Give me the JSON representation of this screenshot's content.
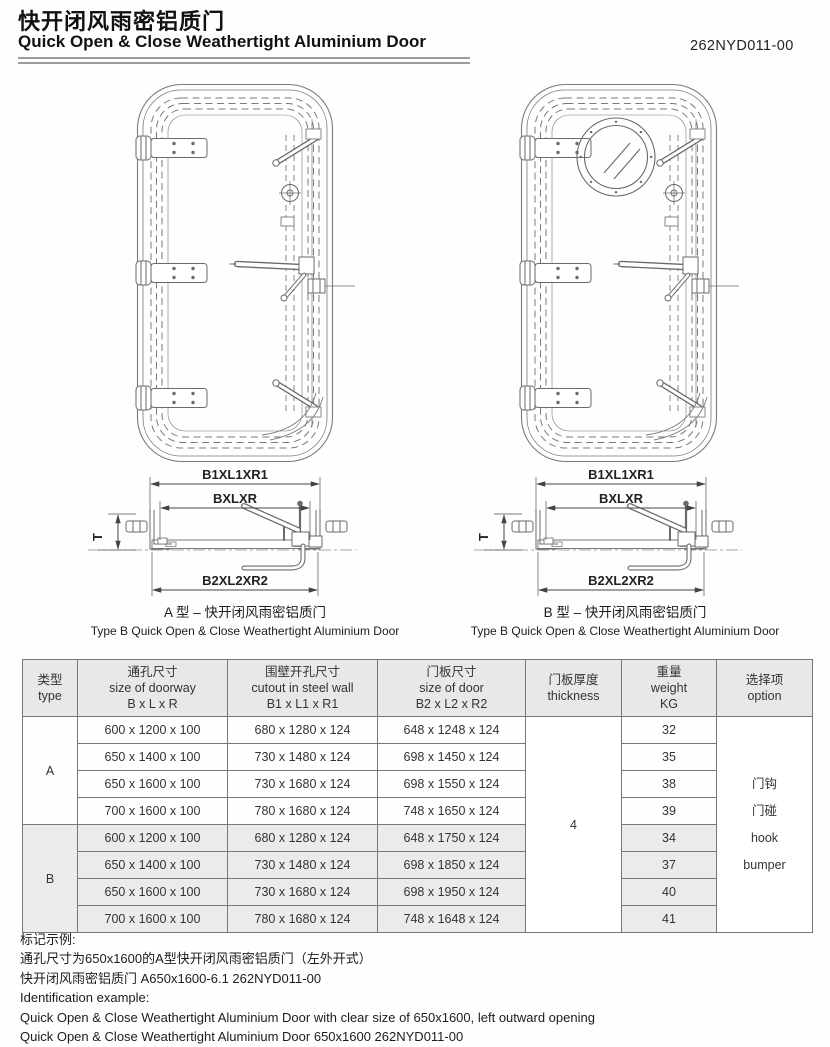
{
  "header": {
    "title_zh": "快开闭风雨密铝质门",
    "title_en": "Quick Open & Close Weathertight Aluminium Door",
    "doc_number": "262NYD011-00"
  },
  "diagrams": {
    "type_a": {
      "caption_zh": "A 型 – 快开闭风雨密铝质门",
      "caption_en": "Type B Quick Open & Close Weathertight Aluminium Door"
    },
    "type_b": {
      "caption_zh": "B 型 – 快开闭风雨密铝质门",
      "caption_en": "Type B Quick Open & Close Weathertight Aluminium Door"
    },
    "section_labels": {
      "top": "B1XL1XR1",
      "middle": "BXLXR",
      "bottom": "B2XL2XR2",
      "thickness": "T"
    }
  },
  "table": {
    "headers": {
      "type_zh": "类型",
      "type_en": "type",
      "doorway_zh": "通孔尺寸",
      "doorway_en": "size of doorway",
      "doorway_dims": "B x L x R",
      "cutout_zh": "围壁开孔尺寸",
      "cutout_en": "cutout in steel wall",
      "cutout_dims": "B1 x L1 x R1",
      "door_zh": "门板尺寸",
      "door_en": "size of door",
      "door_dims": "B2 x L2 x R2",
      "thickness_zh": "门板厚度",
      "thickness_en": "thickness",
      "weight_zh": "重量",
      "weight_en": "weight",
      "weight_unit": "KG",
      "option_zh": "选择项",
      "option_en": "option"
    },
    "thickness_value": "4",
    "option_lines": [
      "门钩",
      "门碰",
      "hook",
      "bumper"
    ],
    "groups": [
      {
        "type": "A",
        "rows": [
          {
            "doorway": "600 x 1200 x 100",
            "cutout": "680 x 1280 x 124",
            "door": "648 x 1248 x 124",
            "weight": "32"
          },
          {
            "doorway": "650 x 1400 x 100",
            "cutout": "730 x 1480 x 124",
            "door": "698 x 1450 x 124",
            "weight": "35"
          },
          {
            "doorway": "650 x 1600 x 100",
            "cutout": "730 x 1680 x 124",
            "door": "698 x 1550 x 124",
            "weight": "38"
          },
          {
            "doorway": "700 x 1600 x 100",
            "cutout": "780 x 1680 x 124",
            "door": "748 x 1650 x 124",
            "weight": "39"
          }
        ]
      },
      {
        "type": "B",
        "rows": [
          {
            "doorway": "600 x 1200 x 100",
            "cutout": "680 x 1280 x 124",
            "door": "648 x 1750 x 124",
            "weight": "34"
          },
          {
            "doorway": "650 x 1400 x 100",
            "cutout": "730 x 1480 x 124",
            "door": "698 x 1850 x 124",
            "weight": "37"
          },
          {
            "doorway": "650 x 1600 x 100",
            "cutout": "730 x 1680 x 124",
            "door": "698 x 1950 x 124",
            "weight": "40"
          },
          {
            "doorway": "700 x 1600 x 100",
            "cutout": "780 x 1680 x 124",
            "door": "748 x 1648 x 124",
            "weight": "41"
          }
        ]
      }
    ]
  },
  "notes": {
    "zh_label": "标记示例:",
    "zh_line1": "通孔尺寸为650x1600的A型快开闭风雨密铝质门（左外开式）",
    "zh_line2": "快开闭风雨密铝质门 A650x1600-6.1 262NYD011-00",
    "en_label": "Identification example:",
    "en_line1": "Quick Open & Close Weathertight Aluminium Door with clear size of 650x1600, left outward opening",
    "en_line2": "Quick Open & Close Weathertight Aluminium Door 650x1600 262NYD011-00"
  },
  "colors": {
    "line": "#777777",
    "dim_line": "#444444",
    "text": "#222222",
    "header_bg": "#e8e8e8",
    "group_b_bg": "#ebebeb"
  }
}
